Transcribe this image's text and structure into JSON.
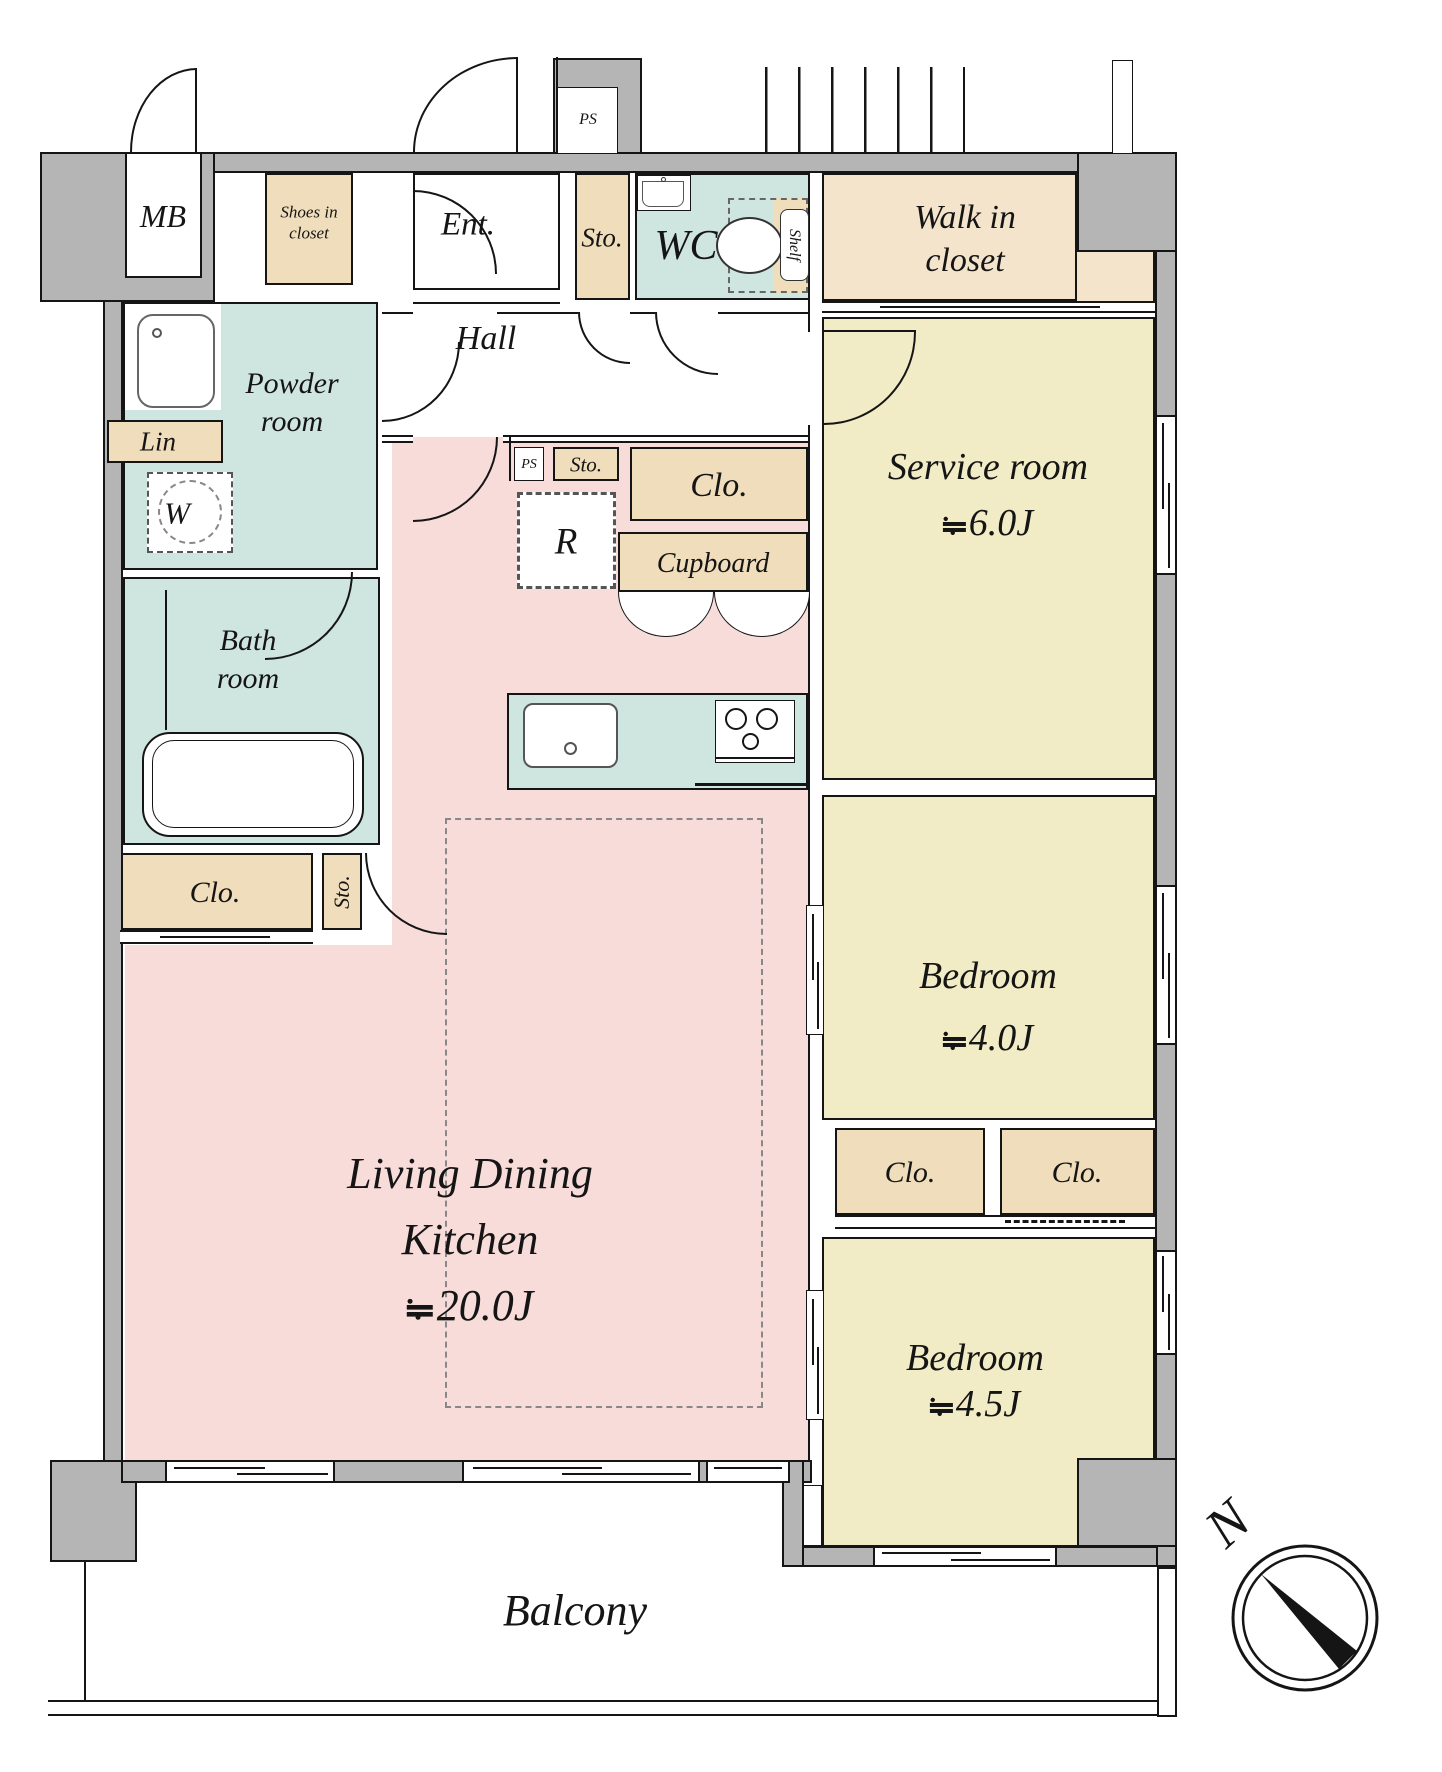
{
  "floorplan": {
    "approx_symbol": "≒",
    "colors": {
      "wall_gray": "#b5b5b5",
      "floor_pink": "#f8dcda",
      "floor_yellow": "#f2ecc6",
      "closet_tan": "#f0ddbb",
      "walkin_tan": "#f4e4cc",
      "wet_area_teal": "#cfe5df",
      "line_black": "#151515"
    },
    "rooms": {
      "mb": "MB",
      "shoes1": "Shoes in",
      "shoes2": "closet",
      "ent": "Ent.",
      "sto_top": "Sto.",
      "ps_shaft": "PS",
      "wc": "WC",
      "shelf": "Shelf",
      "wic1": "Walk in",
      "wic2": "closet",
      "powder1": "Powder",
      "powder2": "room",
      "lin": "Lin",
      "washer": "W",
      "hall": "Hall",
      "ps_small": "PS",
      "sto_small": "Sto.",
      "clo_center": "Clo.",
      "fridge": "R",
      "cupboard": "Cupboard",
      "bath1": "Bath",
      "bath2": "room",
      "clo_left": "Clo.",
      "sto_left": "Sto.",
      "service_name": "Service room",
      "service_area": "6.0J",
      "bed1_name": "Bedroom",
      "bed1_area": "4.0J",
      "clo_a": "Clo.",
      "clo_b": "Clo.",
      "bed2_name": "Bedroom",
      "bed2_area": "4.5J",
      "ldk1": "Living Dining",
      "ldk2": "Kitchen",
      "ldk_area": "20.0J",
      "balcony": "Balcony",
      "compass_n": "N"
    }
  }
}
